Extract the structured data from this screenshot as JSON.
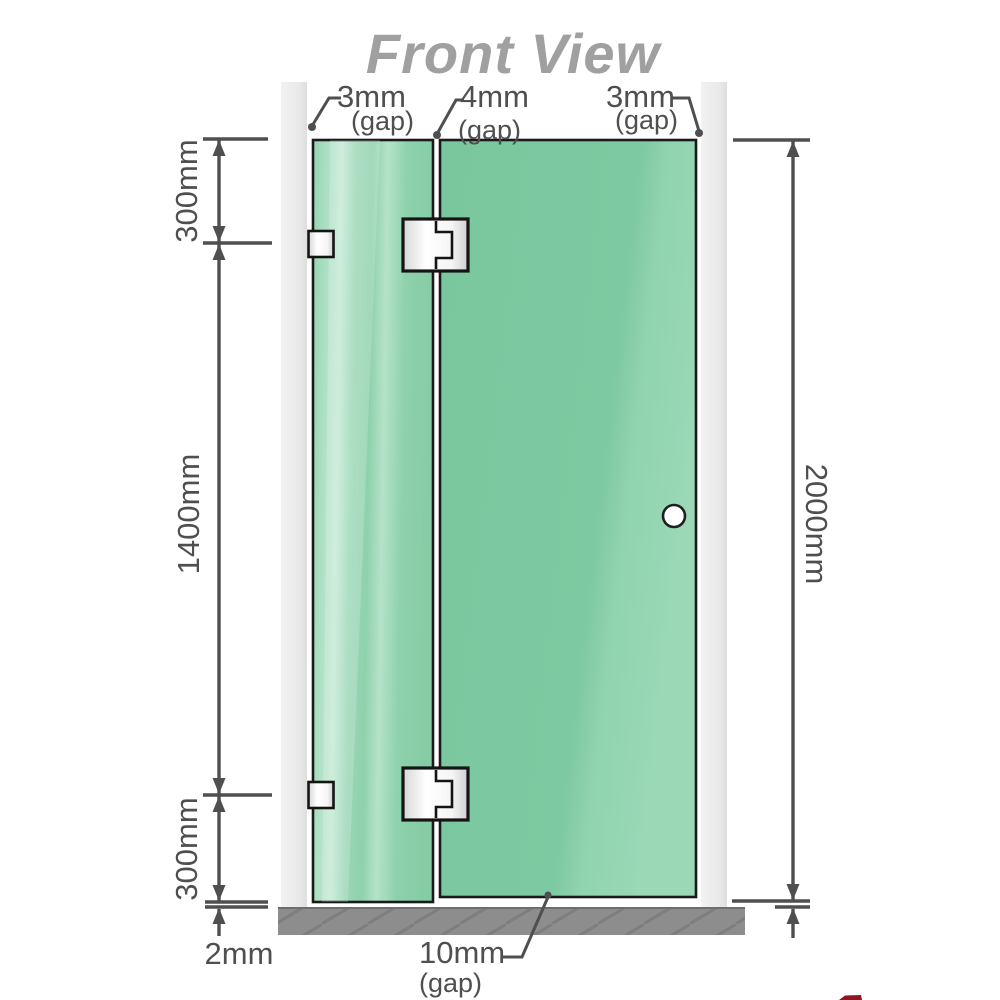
{
  "title": "Front View",
  "labels": {
    "gap_top_left_value": "3mm",
    "gap_top_left_unit": "(gap)",
    "gap_top_middle_value": "4mm",
    "gap_top_middle_unit": "(gap)",
    "gap_top_right_value": "3mm",
    "gap_top_right_unit": "(gap)",
    "gap_bottom_value": "10mm",
    "gap_bottom_unit": "(gap)",
    "height_top_segment": "300mm",
    "height_middle_segment": "1400mm",
    "height_bottom_segment": "300mm",
    "floor_clearance": "2mm",
    "total_height": "2000mm"
  },
  "colors": {
    "glass_base": "#7ec9a1",
    "glass_highlight": "#c0e8d2",
    "glass_stroke": "#1a1a1a",
    "wall_channel": "#e9e9e9",
    "floor": "#8d8d8d",
    "dimension": "#4f4f4f",
    "title_gray": "#a0a0a0",
    "hardware": "#ffffff",
    "watermark": "#8f1622"
  }
}
